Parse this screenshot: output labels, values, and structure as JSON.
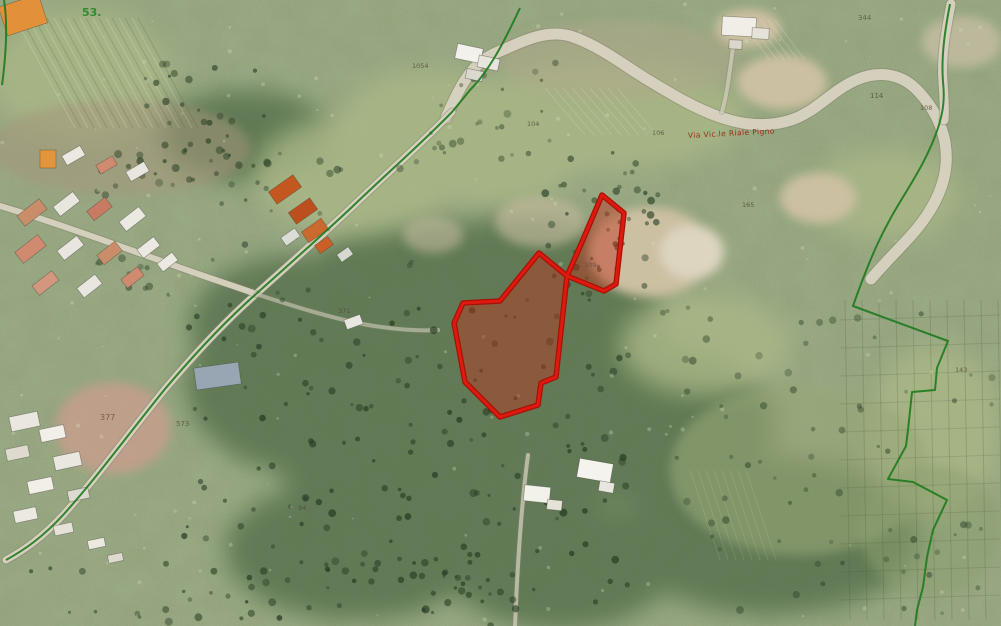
{
  "map": {
    "type": "aerial-orthophoto-with-cadastral-overlay",
    "colors": {
      "terrain_base": "#87986d",
      "parcel_stroke": "#e0190f",
      "parcel_stroke_outer": "#a51208",
      "parcel_fill": "rgba(190,48,28,0.45)",
      "cadastral_green": "#1e7a1e",
      "road_fill": "#d9d3c2",
      "street_label_red": "#9e2b16"
    },
    "street_label": {
      "text": "Via Vic.le Riale Pigno",
      "x": 688,
      "y": 138,
      "rotate": -3,
      "color": "#9e2b16"
    },
    "corner_label": {
      "text": "53.",
      "x": 82,
      "y": 16,
      "color": "#2f8b2f"
    },
    "parcel_highlight": {
      "points": "539,253 567,276 604,291 616,284 624,213 602,195 582,242 567,276 556,377 541,383 538,405 500,417 465,382 454,323 463,303 500,301"
    },
    "cadastral_boundaries": {
      "color": "#1e7a1e",
      "paths": [
        "M950,4 C945,30 941,56 943,82 C945,100 943,112 938,128 C928,158 912,182 897,207 C884,229 872,252 853,306 L948,341 L937,368 L935,390 L912,392 L908,430 L906,446 L888,479 L913,482 L947,500 L933,530 L927,557 L923,587 L917,610 L915,626",
        "M520,8 C505,40 490,70 470,90 C462,100 457,106 452,112 C420,145 385,175 352,207 C318,239 285,268 256,294 C230,317 198,350 165,389 C130,432 98,476 64,514 C42,538 24,550 6,560",
        "M4,0 C8,25 6,55 2,85"
      ]
    },
    "roads": [
      {
        "d": "M446,118 C458,92 468,64 498,52 C524,41 549,27 576,38 C602,48 622,64 648,80 C670,93 692,107 717,116 C742,125 766,128 791,120 C816,112 831,91 856,80 C879,70 901,74 916,89 C931,104 941,122 945,142 C949,166 944,188 929,212 C914,236 893,253 871,279",
        "w": 11
      },
      {
        "d": "M951,4 C946,30 941,56 943,82 C944,98 945,108 944,120",
        "w": 9
      },
      {
        "d": "M452,112 C420,145 385,175 352,207 C318,239 285,268 256,294 C230,317 198,350 165,389 C130,432 98,476 64,514 C42,538 24,550 6,560",
        "w": 7
      },
      {
        "d": "M0,206 C55,222 138,253 198,274 C224,283 243,289 256,294",
        "w": 6
      },
      {
        "d": "M256,294 C290,305 330,318 368,325 C398,330 420,331 438,330",
        "w": 4,
        "o": 0.55
      },
      {
        "d": "M528,455 C522,500 518,550 515,626",
        "w": 4,
        "o": 0.7
      },
      {
        "d": "M722,112 C728,90 730,68 733,48",
        "w": 4,
        "o": 0.7
      }
    ],
    "buildings": [
      [
        2,
        0,
        42,
        30,
        -18,
        "#e2913a"
      ],
      [
        40,
        150,
        16,
        18,
        0,
        "#e2953c"
      ],
      [
        63,
        150,
        21,
        11,
        -30,
        "#ece9e2"
      ],
      [
        97,
        160,
        19,
        10,
        -30,
        "#cf8a70"
      ],
      [
        127,
        166,
        21,
        11,
        -30,
        "#e8e6df"
      ],
      [
        18,
        206,
        28,
        13,
        -38,
        "#c98d6a"
      ],
      [
        54,
        198,
        25,
        12,
        -38,
        "#e8e6df"
      ],
      [
        88,
        203,
        23,
        12,
        -38,
        "#c97a62"
      ],
      [
        120,
        213,
        25,
        12,
        -38,
        "#ece9e2"
      ],
      [
        16,
        242,
        29,
        14,
        -38,
        "#cf8a70"
      ],
      [
        58,
        242,
        25,
        12,
        -38,
        "#e8e6df"
      ],
      [
        98,
        247,
        23,
        12,
        -38,
        "#c98d6a"
      ],
      [
        138,
        242,
        21,
        11,
        -38,
        "#ece9e2"
      ],
      [
        33,
        277,
        25,
        12,
        -38,
        "#d3977e"
      ],
      [
        78,
        280,
        23,
        12,
        -38,
        "#e8e6df"
      ],
      [
        122,
        272,
        21,
        11,
        -38,
        "#cf8a70"
      ],
      [
        158,
        257,
        19,
        10,
        -38,
        "#ece9e2"
      ],
      [
        270,
        182,
        30,
        15,
        -35,
        "#c2571f"
      ],
      [
        290,
        204,
        26,
        14,
        -35,
        "#bb4f1d"
      ],
      [
        303,
        224,
        24,
        13,
        -35,
        "#ca6a2e"
      ],
      [
        282,
        232,
        17,
        10,
        -35,
        "#dcdcd6"
      ],
      [
        316,
        240,
        16,
        10,
        -35,
        "#cc5f28"
      ],
      [
        338,
        250,
        14,
        9,
        -35,
        "#d8d8d2"
      ],
      [
        456,
        46,
        26,
        15,
        12,
        "#f2f1ec"
      ],
      [
        478,
        57,
        21,
        12,
        12,
        "#e7e5dd"
      ],
      [
        466,
        70,
        17,
        10,
        12,
        "#dbd8cd"
      ],
      [
        722,
        17,
        34,
        19,
        3,
        "#f0eee7"
      ],
      [
        752,
        28,
        17,
        11,
        3,
        "#e5e2d7"
      ],
      [
        729,
        40,
        13,
        9,
        3,
        "#dcd7ca"
      ],
      [
        195,
        365,
        45,
        22,
        -8,
        "#97a6b2"
      ],
      [
        10,
        414,
        29,
        15,
        -12,
        "#e9e7df"
      ],
      [
        40,
        427,
        25,
        13,
        -12,
        "#f1efe7"
      ],
      [
        6,
        447,
        23,
        12,
        -12,
        "#dedacd"
      ],
      [
        54,
        454,
        27,
        14,
        -12,
        "#e9e7df"
      ],
      [
        28,
        479,
        25,
        13,
        -12,
        "#f1efe7"
      ],
      [
        68,
        489,
        21,
        11,
        -12,
        "#dcdacf"
      ],
      [
        14,
        509,
        23,
        12,
        -12,
        "#ece9e1"
      ],
      [
        54,
        524,
        19,
        10,
        -12,
        "#e5e2d7"
      ],
      [
        88,
        539,
        17,
        9,
        -12,
        "#ece9e1"
      ],
      [
        108,
        554,
        15,
        8,
        -12,
        "#dedacd"
      ],
      [
        524,
        486,
        26,
        16,
        6,
        "#f2f1ea"
      ],
      [
        547,
        500,
        15,
        10,
        6,
        "#e5e2d8"
      ],
      [
        578,
        461,
        34,
        19,
        10,
        "#f4f3ee"
      ],
      [
        599,
        482,
        15,
        10,
        10,
        "#e8e6de"
      ],
      [
        345,
        317,
        17,
        10,
        -20,
        "#e8e6e0"
      ]
    ],
    "parcel_numbers": [
      {
        "t": "377",
        "x": 100,
        "y": 420,
        "c": "#6b4a3a",
        "s": 8
      },
      {
        "t": "573",
        "x": 176,
        "y": 426,
        "c": "#55503a",
        "s": 7
      },
      {
        "t": "344",
        "x": 858,
        "y": 20,
        "c": "#4d5a3a",
        "s": 7
      },
      {
        "t": "114",
        "x": 870,
        "y": 98,
        "c": "#4d4a33",
        "s": 7
      },
      {
        "t": "108",
        "x": 920,
        "y": 110,
        "c": "#4d4a33",
        "s": 6.5
      },
      {
        "t": "104",
        "x": 527,
        "y": 126,
        "c": "#4d4a33",
        "s": 6.5
      },
      {
        "t": "1054",
        "x": 412,
        "y": 68,
        "c": "#4d4a33",
        "s": 6.5
      },
      {
        "t": "109",
        "x": 584,
        "y": 267,
        "c": "#5a4a3a",
        "s": 6.5
      },
      {
        "t": "371",
        "x": 338,
        "y": 313,
        "c": "#4d4a33",
        "s": 6.5
      },
      {
        "t": "94",
        "x": 298,
        "y": 510,
        "c": "#4d4a33",
        "s": 6.5
      },
      {
        "t": "143",
        "x": 955,
        "y": 372,
        "c": "#4d4a33",
        "s": 6.5
      },
      {
        "t": "165",
        "x": 742,
        "y": 207,
        "c": "#4d4a33",
        "s": 6.5
      },
      {
        "t": "106",
        "x": 652,
        "y": 135,
        "c": "#4d4a33",
        "s": 6.5
      }
    ]
  }
}
